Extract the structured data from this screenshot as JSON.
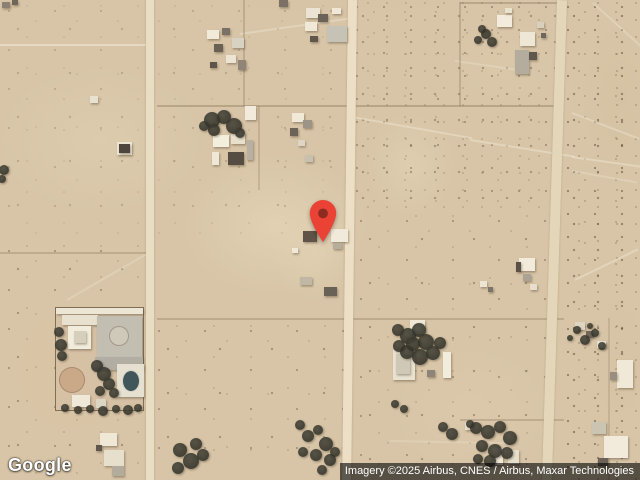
{
  "branding": {
    "logo_text": "Google"
  },
  "attribution": {
    "text": "Imagery ©2025 Airbus, CNES / Airbus, Maxar Technologies",
    "bg": "rgba(0,0,0,0.6)"
  },
  "marker": {
    "x": 323,
    "y": 200,
    "width": 28,
    "height": 42,
    "color": "#EA4335",
    "dot_color": "#8D2A21"
  },
  "palette": {
    "desert_base": "#d8c5a7",
    "tree_default": "#45443a"
  },
  "scene": {
    "patches": [
      {
        "x": -40,
        "y": 40,
        "w": 280,
        "h": 200,
        "c": "#e0d0b2",
        "o": 0.55
      },
      {
        "x": 150,
        "y": 130,
        "w": 250,
        "h": 190,
        "c": "#e8d8ba",
        "o": 0.6
      },
      {
        "x": 255,
        "y": 180,
        "w": 120,
        "h": 140,
        "c": "#e3d3b5",
        "o": 0.55
      },
      {
        "x": 350,
        "y": 95,
        "w": 120,
        "h": 140,
        "c": "#e6d6b8",
        "o": 0.5
      },
      {
        "x": -30,
        "y": 250,
        "w": 200,
        "h": 240,
        "c": "#dcc2a4",
        "o": 0.45
      },
      {
        "x": 560,
        "y": -20,
        "w": 120,
        "h": 240,
        "c": "#d2bfa0",
        "o": 0.5
      },
      {
        "x": 560,
        "y": 220,
        "w": 120,
        "h": 280,
        "c": "#d5c2a3",
        "o": 0.45
      },
      {
        "x": 360,
        "y": 320,
        "w": 220,
        "h": 180,
        "c": "#dfcbad",
        "o": 0.5
      },
      {
        "x": 430,
        "y": 0,
        "w": 150,
        "h": 120,
        "c": "#decbac",
        "o": 0.4
      },
      {
        "x": 0,
        "y": -30,
        "w": 660,
        "h": 60,
        "c": "#d5c2a4",
        "o": 0.4
      }
    ],
    "scrub": [
      {
        "x": 563,
        "y": 0,
        "w": 77,
        "h": 480,
        "d": "dense",
        "o": 1
      },
      {
        "x": 352,
        "y": 0,
        "w": 215,
        "h": 210,
        "d": "dense",
        "o": 0.75
      },
      {
        "x": 352,
        "y": 210,
        "w": 211,
        "h": 270,
        "d": "sparse",
        "o": 1
      },
      {
        "x": 0,
        "y": 240,
        "w": 150,
        "h": 240,
        "d": "sparse",
        "o": 1
      },
      {
        "x": 150,
        "y": 320,
        "w": 205,
        "h": 160,
        "d": "sparse",
        "o": 1
      },
      {
        "x": 0,
        "y": 0,
        "w": 352,
        "h": 240,
        "d": "sparse",
        "o": 0.6
      }
    ],
    "trails": [
      {
        "x": 240,
        "y": 33,
        "w": 112,
        "rot": -8,
        "o": 0.45
      },
      {
        "x": 352,
        "y": 116,
        "w": 122,
        "rot": 10,
        "o": 0.5
      },
      {
        "x": 470,
        "y": 139,
        "w": 106,
        "rot": 9,
        "o": 0.5
      },
      {
        "x": 572,
        "y": 156,
        "w": 70,
        "rot": 8,
        "o": 0.5
      },
      {
        "x": 572,
        "y": 112,
        "w": 72,
        "rot": 21,
        "o": 0.45
      },
      {
        "x": 593,
        "y": 2,
        "w": 66,
        "rot": 42,
        "o": 0.4
      },
      {
        "x": 575,
        "y": 279,
        "w": 70,
        "rot": -26,
        "o": 0.5
      },
      {
        "x": 67,
        "y": 299,
        "w": 94,
        "rot": -30,
        "o": 0.35
      },
      {
        "x": 572,
        "y": 170,
        "w": 66,
        "rot": 10,
        "o": 0.35
      },
      {
        "x": 390,
        "y": 440,
        "w": 120,
        "rot": 1,
        "o": 0.3
      },
      {
        "x": 455,
        "y": 60,
        "w": 70,
        "rot": 8,
        "o": 0.35
      }
    ],
    "lines": [
      {
        "x": 0,
        "y": 44,
        "w": 148,
        "h": 1.5,
        "c": "rgba(240,232,212,0.6)"
      },
      {
        "x": 157,
        "y": 105,
        "w": 400,
        "h": 1.8,
        "c": "rgba(125,105,80,0.35)"
      },
      {
        "x": 0,
        "y": 252,
        "w": 150,
        "h": 1.5,
        "c": "rgba(125,105,80,0.28)"
      },
      {
        "x": 157,
        "y": 318,
        "w": 407,
        "h": 1.8,
        "c": "rgba(125,105,80,0.3)"
      },
      {
        "x": 460,
        "y": 2,
        "w": 100,
        "h": 1.5,
        "c": "rgba(125,105,80,0.32)"
      },
      {
        "x": 460,
        "y": 419,
        "w": 104,
        "h": 1.5,
        "c": "rgba(125,105,80,0.28)"
      },
      {
        "x": 243,
        "y": 0,
        "w": 1.5,
        "h": 106,
        "c": "rgba(125,105,80,0.28)"
      },
      {
        "x": 459,
        "y": 2,
        "w": 1.5,
        "h": 104,
        "c": "rgba(125,105,80,0.28)"
      },
      {
        "x": 258,
        "y": 106,
        "w": 1.5,
        "h": 84,
        "c": "rgba(135,112,86,0.25)"
      },
      {
        "x": 608,
        "y": 318,
        "w": 1.5,
        "h": 162,
        "c": "rgba(125,105,80,0.2)"
      }
    ],
    "roads": [
      {
        "x": 146,
        "y": 0,
        "w": 8,
        "h": 481,
        "c": "#e9ddc3",
        "rot": 0
      },
      {
        "x": 348,
        "y": 0,
        "w": 9,
        "h": 481,
        "c": "#ecdfc5",
        "rot": 0.7
      },
      {
        "x": 557,
        "y": 0,
        "w": 10,
        "h": 481,
        "c": "#e4d6b9",
        "rot": 1.8
      }
    ],
    "outlines": [
      {
        "x": 55,
        "y": 307,
        "w": 89,
        "h": 104,
        "c": "rgba(112,96,74,0.85)",
        "bg": "#d6c1a4"
      }
    ],
    "buildings_format": "[x, y, w, h, color]",
    "buildings": [
      [
        306,
        8,
        14,
        10,
        "#ece4d2"
      ],
      [
        318,
        14,
        10,
        8,
        "#6b6258"
      ],
      [
        305,
        22,
        12,
        9,
        "#f0e9d8"
      ],
      [
        327,
        26,
        20,
        16,
        "#c6c2b6"
      ],
      [
        332,
        8,
        9,
        6,
        "#efe8d6"
      ],
      [
        310,
        36,
        8,
        6,
        "#5f574c"
      ],
      [
        279,
        0,
        9,
        7,
        "#7b7265"
      ],
      [
        207,
        30,
        12,
        9,
        "#f1ead9"
      ],
      [
        222,
        28,
        8,
        7,
        "#7a7166"
      ],
      [
        232,
        38,
        12,
        10,
        "#d8d2c2"
      ],
      [
        214,
        44,
        9,
        8,
        "#6a6155"
      ],
      [
        226,
        55,
        10,
        8,
        "#ece5d3"
      ],
      [
        238,
        60,
        8,
        10,
        "#8f8678"
      ],
      [
        210,
        62,
        7,
        6,
        "#5d5549"
      ],
      [
        90,
        96,
        8,
        7,
        "#e9e1cf"
      ],
      [
        117,
        142,
        15,
        13,
        "#ece5d3"
      ],
      [
        119,
        144,
        11,
        9,
        "#4e463c"
      ],
      [
        245,
        106,
        11,
        14,
        "#f2ebdb"
      ],
      [
        213,
        135,
        16,
        12,
        "#f4eedd"
      ],
      [
        231,
        133,
        14,
        11,
        "#e8e0cc"
      ],
      [
        228,
        152,
        16,
        13,
        "#554d42"
      ],
      [
        212,
        152,
        7,
        13,
        "#efe8d6"
      ],
      [
        247,
        140,
        6,
        20,
        "#b8b0a0"
      ],
      [
        292,
        113,
        12,
        9,
        "#f0e9d8"
      ],
      [
        303,
        120,
        9,
        8,
        "#9c9486"
      ],
      [
        290,
        128,
        8,
        8,
        "#6b6357"
      ],
      [
        298,
        140,
        7,
        6,
        "#ded6c2"
      ],
      [
        305,
        155,
        8,
        7,
        "#c9c1af"
      ],
      [
        497,
        15,
        15,
        12,
        "#f3ecdc"
      ],
      [
        520,
        32,
        15,
        14,
        "#eee7d5"
      ],
      [
        537,
        22,
        7,
        6,
        "#d8d0bd"
      ],
      [
        515,
        50,
        14,
        24,
        "#b4ac9c"
      ],
      [
        529,
        52,
        8,
        8,
        "#60584d"
      ],
      [
        541,
        33,
        5,
        5,
        "#6f675b"
      ],
      [
        505,
        8,
        7,
        5,
        "#e9e2cf"
      ],
      [
        480,
        281,
        7,
        6,
        "#ece5d3"
      ],
      [
        488,
        287,
        5,
        5,
        "#7d7468"
      ],
      [
        519,
        258,
        16,
        13,
        "#f2ebda"
      ],
      [
        516,
        262,
        5,
        10,
        "#5a5247"
      ],
      [
        523,
        274,
        8,
        7,
        "#aaa292"
      ],
      [
        530,
        284,
        7,
        6,
        "#e7dfcc"
      ],
      [
        303,
        231,
        14,
        11,
        "#5f5246"
      ],
      [
        331,
        229,
        17,
        13,
        "#f1eadb"
      ],
      [
        333,
        243,
        9,
        6,
        "#b6ad9c"
      ],
      [
        292,
        248,
        6,
        5,
        "#f0e9d8"
      ],
      [
        300,
        277,
        12,
        8,
        "#c0b7a5"
      ],
      [
        324,
        287,
        13,
        9,
        "#6a6156"
      ],
      [
        410,
        320,
        15,
        14,
        "#efe8d7"
      ],
      [
        393,
        350,
        22,
        30,
        "#e9e2d0"
      ],
      [
        396,
        354,
        14,
        20,
        "#cfc8b6"
      ],
      [
        443,
        352,
        8,
        26,
        "#f2ecdc"
      ],
      [
        427,
        370,
        8,
        7,
        "#8d8477"
      ],
      [
        575,
        322,
        10,
        8,
        "#ded6c3"
      ],
      [
        586,
        331,
        8,
        7,
        "#6f665a"
      ],
      [
        597,
        341,
        9,
        7,
        "#e8e1cf"
      ],
      [
        617,
        360,
        16,
        28,
        "#f0e9d8"
      ],
      [
        610,
        372,
        7,
        8,
        "#988f80"
      ],
      [
        592,
        422,
        14,
        12,
        "#ccc4b2"
      ],
      [
        604,
        436,
        24,
        22,
        "#f2ebdb"
      ],
      [
        598,
        458,
        10,
        8,
        "#6b6357"
      ],
      [
        493,
        448,
        10,
        17,
        "#f0e9d9"
      ],
      [
        508,
        450,
        11,
        14,
        "#e6dfcc"
      ],
      [
        465,
        423,
        8,
        7,
        "#e9e2d0"
      ],
      [
        100,
        433,
        17,
        13,
        "#efe8d7"
      ],
      [
        104,
        450,
        20,
        16,
        "#e6dfcc"
      ],
      [
        112,
        466,
        12,
        10,
        "#b3ab9b"
      ],
      [
        96,
        445,
        6,
        6,
        "#5f574b"
      ],
      [
        2,
        2,
        8,
        6,
        "#8b8275"
      ],
      [
        12,
        0,
        6,
        5,
        "#6f665a"
      ],
      [
        56,
        308,
        87,
        6,
        "#eee6d4"
      ],
      [
        62,
        315,
        36,
        10,
        "#e9e1cf"
      ],
      [
        97,
        316,
        45,
        42,
        "#c2beb2"
      ],
      [
        68,
        326,
        23,
        23,
        "#f2ecdc"
      ],
      [
        74,
        331,
        12,
        12,
        "#d6cfbc"
      ],
      [
        95,
        357,
        48,
        13,
        "#b2aea4"
      ],
      [
        117,
        364,
        27,
        33,
        "#e6e0d0"
      ],
      [
        72,
        395,
        18,
        12,
        "#f0e9d9"
      ],
      [
        96,
        399,
        10,
        9,
        "#ddd5c3"
      ]
    ],
    "circles": [
      {
        "x": 119,
        "y": 336,
        "rx": 10,
        "ry": 10,
        "c": "#cfc9b9",
        "b": "rgba(150,140,120,0.8)"
      },
      {
        "x": 72,
        "y": 380,
        "rx": 13,
        "ry": 13,
        "c": "#c9a987",
        "b": "rgba(165,135,105,0.9)"
      },
      {
        "x": 131,
        "y": 381,
        "rx": 9,
        "ry": 11,
        "c": "#41565a",
        "b": "rgba(230,224,210,0.9)"
      }
    ],
    "trees_format": "[x, y, r, color?]",
    "trees": [
      [
        212,
        120,
        8
      ],
      [
        224,
        117,
        7
      ],
      [
        234,
        126,
        8
      ],
      [
        214,
        130,
        6
      ],
      [
        204,
        126,
        5
      ],
      [
        240,
        133,
        5
      ],
      [
        59,
        332,
        5
      ],
      [
        61,
        345,
        6
      ],
      [
        62,
        356,
        5
      ],
      [
        97,
        366,
        6
      ],
      [
        104,
        374,
        7
      ],
      [
        109,
        384,
        6
      ],
      [
        100,
        391,
        5
      ],
      [
        114,
        393,
        5
      ],
      [
        65,
        408,
        4
      ],
      [
        78,
        410,
        4
      ],
      [
        90,
        409,
        4
      ],
      [
        103,
        411,
        5
      ],
      [
        116,
        409,
        4
      ],
      [
        128,
        410,
        5
      ],
      [
        138,
        408,
        4
      ],
      [
        398,
        330,
        6
      ],
      [
        408,
        336,
        8
      ],
      [
        419,
        330,
        7
      ],
      [
        426,
        342,
        8
      ],
      [
        433,
        353,
        7
      ],
      [
        420,
        357,
        8
      ],
      [
        407,
        352,
        7
      ],
      [
        440,
        343,
        6
      ],
      [
        399,
        346,
        6
      ],
      [
        413,
        344,
        7
      ],
      [
        486,
        34,
        5
      ],
      [
        492,
        42,
        5
      ],
      [
        482,
        29,
        4
      ],
      [
        478,
        40,
        4
      ],
      [
        443,
        427,
        5
      ],
      [
        452,
        434,
        6
      ],
      [
        476,
        428,
        6
      ],
      [
        488,
        432,
        7
      ],
      [
        500,
        427,
        6
      ],
      [
        510,
        438,
        7
      ],
      [
        482,
        446,
        6
      ],
      [
        495,
        451,
        7
      ],
      [
        507,
        453,
        6
      ],
      [
        478,
        459,
        5
      ],
      [
        490,
        461,
        6
      ],
      [
        470,
        424,
        4
      ],
      [
        180,
        450,
        7
      ],
      [
        191,
        461,
        8
      ],
      [
        178,
        468,
        6
      ],
      [
        196,
        444,
        6
      ],
      [
        203,
        455,
        6
      ],
      [
        300,
        425,
        5
      ],
      [
        308,
        436,
        6
      ],
      [
        318,
        430,
        5
      ],
      [
        326,
        444,
        7
      ],
      [
        316,
        455,
        6
      ],
      [
        330,
        460,
        6
      ],
      [
        322,
        470,
        5
      ],
      [
        335,
        452,
        5
      ],
      [
        303,
        452,
        5
      ],
      [
        577,
        330,
        4
      ],
      [
        585,
        340,
        5
      ],
      [
        595,
        333,
        4
      ],
      [
        602,
        346,
        4
      ],
      [
        590,
        326,
        3
      ],
      [
        570,
        338,
        3
      ],
      [
        4,
        170,
        5
      ],
      [
        2,
        179,
        4
      ],
      [
        395,
        404,
        4
      ],
      [
        404,
        409,
        4
      ]
    ]
  }
}
